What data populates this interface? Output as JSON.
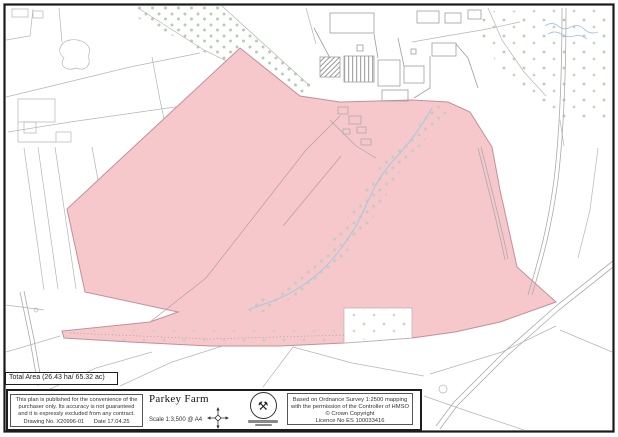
{
  "document": {
    "total_area": "Total Area (26.43 ha/ 65.32 ac)",
    "title": "Parkey Farm",
    "scale": "Scale 1:3,500 @ A4",
    "disclaimer_lines": [
      "This plan is published for the convenience of the",
      "purchaser only. Its accuracy is not guaranteed",
      "and it is expressly excluded from any contract."
    ],
    "drawing_no": "Drawing No. X20996-01",
    "date": "Date 17.04.25",
    "os_attribution_lines": [
      "Based on Ordnance Survey 1:2500 mapping",
      "with the permission of the Controller of HMSO",
      "© Crown Copyright",
      "Licence No ES 100033416"
    ]
  },
  "icons": {
    "logo_glyph": "⚒",
    "logo_name": "crossed-hammers-badge",
    "compass_name": "north-compass-mark"
  },
  "map": {
    "colors": {
      "parcel_fill": "#f6c7cb",
      "parcel_stroke": "#c48f96",
      "field_line": "#b5b5b5",
      "woodland_dot": "#b7ceb1",
      "water": "#a9c7e6",
      "road_line": "#ababab",
      "frame": "#1a1a1a"
    }
  }
}
